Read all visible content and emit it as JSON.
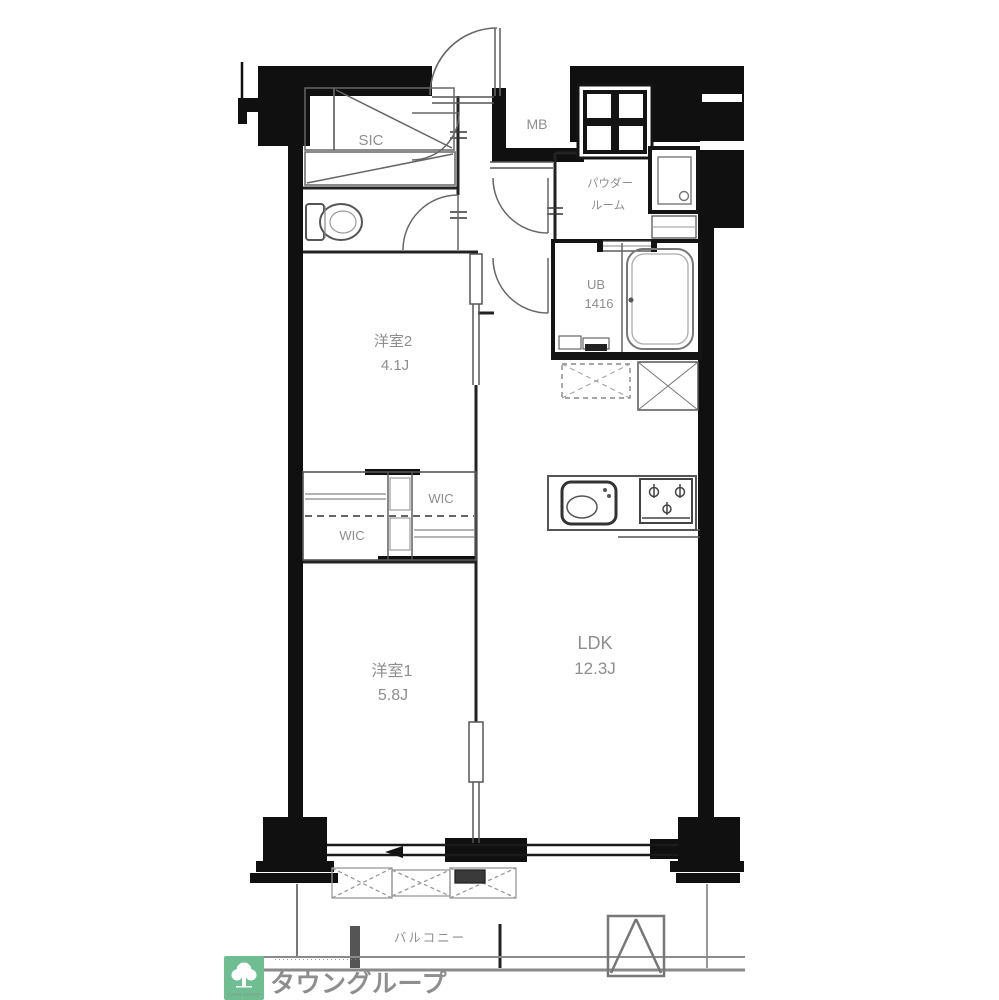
{
  "colors": {
    "wall": "#101010",
    "thin_line": "#2a2a2a",
    "fixture_line": "#777777",
    "room_label": "#8e8e8e",
    "logo_green": "#6fbe92",
    "brand_text": "#7cc49b"
  },
  "rooms": {
    "sic": {
      "label": "SIC"
    },
    "mb": {
      "label": "MB"
    },
    "powder_room": {
      "label_line1": "パウダー",
      "label_line2": "ルーム"
    },
    "unit_bath": {
      "label": "UB",
      "size_label": "1416"
    },
    "bedroom2": {
      "label": "洋室2",
      "area_label": "4.1J"
    },
    "wic_upper": {
      "label": "WIC"
    },
    "wic_lower": {
      "label": "WIC"
    },
    "bedroom1": {
      "label": "洋室1",
      "area_label": "5.8J"
    },
    "ldk": {
      "label": "LDK",
      "area_label": "12.3J"
    },
    "balcony": {
      "label": "バルコニー"
    }
  },
  "branding": {
    "tagline_dots": "･･････････････････････",
    "brand_name": "タウングループ",
    "logo_caption": "TOWN GROUP"
  }
}
